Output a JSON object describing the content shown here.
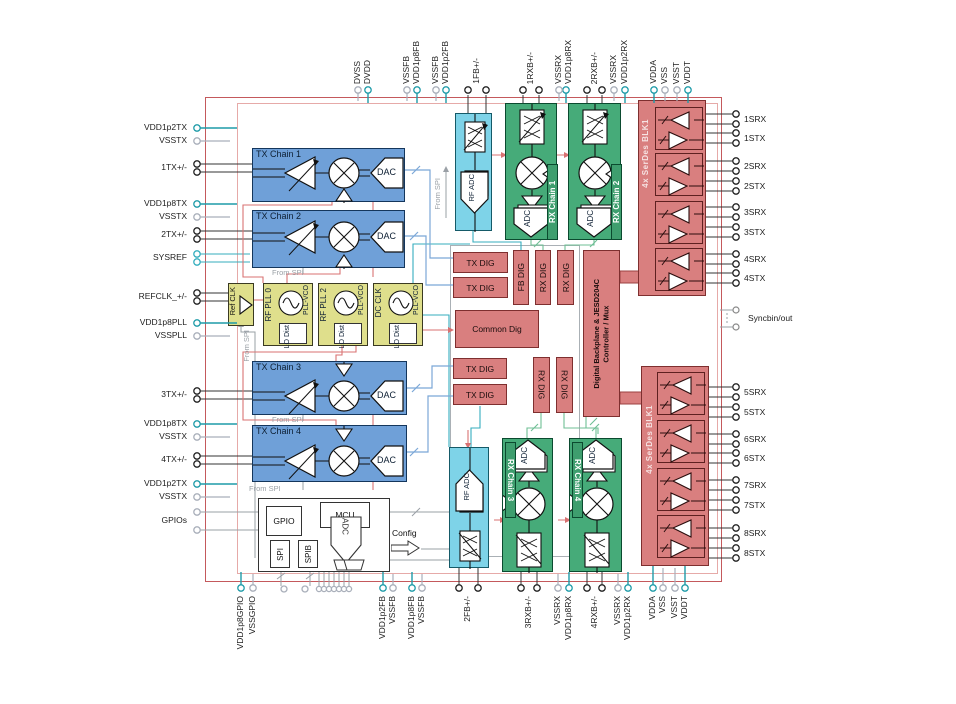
{
  "figure": {
    "kind": "functional-block-diagram"
  },
  "blocks": {
    "tx_chain_1": "TX Chain 1",
    "tx_chain_2": "TX Chain 2",
    "tx_chain_3": "TX Chain 3",
    "tx_chain_4": "TX Chain 4",
    "dac": "DAC",
    "adc": "ADC",
    "rf_adc": "RF ADC",
    "rx_chain_1": "RX Chain 1",
    "rx_chain_2": "RX Chain 2",
    "rx_chain_3": "RX Chain 3",
    "rx_chain_4": "RX Chain 4",
    "ref_clk": "Ref CLK",
    "rf_pll_0": "RF PLL 0",
    "rf_pll_2": "RF PLL 2",
    "dc_clk": "DC CLK",
    "pll_vco": "PLL-VCO",
    "lo_dist": "LO Dist",
    "tx_dig": "TX DIG",
    "fb_dig": "FB DIG",
    "rx_dig": "RX DIG",
    "common_dig": "Common Dig",
    "jesd_line1": "Digital Backplane & JESD204C",
    "jesd_line2": "Controller / Mux",
    "serdes": "4x SerDes BLK1",
    "gpio": "GPIO",
    "mcu": "MCU",
    "spi": "SPI",
    "spib": "SPIB",
    "aux_adc": "ADC",
    "config": "Config",
    "from_spi": "From SPI",
    "syncb": "Syncbin/out"
  },
  "colors": {
    "tx_blue": "#6fa0d8",
    "pll_yellow": "#dfdf8c",
    "adc_cyan": "#7ed3e8",
    "rx_green": "#46ab79",
    "digital_salmon": "#d97f7f",
    "chip_border": "#c4595c",
    "supply_teal": "#1e9ba8",
    "ground_gray": "#a9afba"
  },
  "pins": {
    "left": [
      {
        "label": "VDD1p2TX",
        "type": "supply"
      },
      {
        "label": "VSSTX",
        "type": "ground"
      },
      {
        "label": "1TX+/-",
        "type": "signal"
      },
      {
        "label": "VDD1p8TX",
        "type": "supply"
      },
      {
        "label": "VSSTX",
        "type": "ground"
      },
      {
        "label": "2TX+/-",
        "type": "signal"
      },
      {
        "label": "SYSREF",
        "type": "signal"
      },
      {
        "label": "REFCLK_+/-",
        "type": "signal"
      },
      {
        "label": "VDD1p8PLL",
        "type": "supply"
      },
      {
        "label": "VSSPLL",
        "type": "ground"
      },
      {
        "label": "3TX+/-",
        "type": "signal"
      },
      {
        "label": "VDD1p8TX",
        "type": "supply"
      },
      {
        "label": "VSSTX",
        "type": "ground"
      },
      {
        "label": "4TX+/-",
        "type": "signal"
      },
      {
        "label": "VDD1p2TX",
        "type": "supply"
      },
      {
        "label": "VSSTX",
        "type": "ground"
      },
      {
        "label": "GPIOs",
        "type": "signal"
      }
    ],
    "top": [
      {
        "label": "DVSS",
        "type": "ground"
      },
      {
        "label": "DVDD",
        "type": "supply"
      },
      {
        "label": "VSSFB",
        "type": "ground"
      },
      {
        "label": "VDD1p8FB",
        "type": "supply"
      },
      {
        "label": "VSSFB",
        "type": "ground"
      },
      {
        "label": "VDD1p2FB",
        "type": "supply"
      },
      {
        "label": "1FB+/-",
        "type": "signal"
      },
      {
        "label": "1RXB+/-",
        "type": "signal"
      },
      {
        "label": "VSSRX",
        "type": "ground"
      },
      {
        "label": "VDD1p8RX",
        "type": "supply"
      },
      {
        "label": "2RXB+/-",
        "type": "signal"
      },
      {
        "label": "VSSRX",
        "type": "ground"
      },
      {
        "label": "VDD1p2RX",
        "type": "supply"
      },
      {
        "label": "VDDA",
        "type": "supply"
      },
      {
        "label": "VSS",
        "type": "ground"
      },
      {
        "label": "VSST",
        "type": "ground"
      },
      {
        "label": "VDDT",
        "type": "supply"
      }
    ],
    "right": [
      {
        "label": "1SRX"
      },
      {
        "label": "1STX"
      },
      {
        "label": "2SRX"
      },
      {
        "label": "2STX"
      },
      {
        "label": "3SRX"
      },
      {
        "label": "3STX"
      },
      {
        "label": "4SRX"
      },
      {
        "label": "4STX"
      },
      {
        "label": "Syncbin/out"
      },
      {
        "label": "5SRX"
      },
      {
        "label": "5STX"
      },
      {
        "label": "6SRX"
      },
      {
        "label": "6STX"
      },
      {
        "label": "7SRX"
      },
      {
        "label": "7STX"
      },
      {
        "label": "8SRX"
      },
      {
        "label": "8STX"
      }
    ],
    "bottom": [
      {
        "label": "VDD1p8GPIO",
        "type": "supply"
      },
      {
        "label": "VSSGPIO",
        "type": "ground"
      },
      {
        "label": "VDD1p2FB",
        "type": "supply"
      },
      {
        "label": "VSSFB",
        "type": "ground"
      },
      {
        "label": "VDD1p8FB",
        "type": "supply"
      },
      {
        "label": "VSSFB",
        "type": "ground"
      },
      {
        "label": "2FB+/-",
        "type": "signal"
      },
      {
        "label": "3RXB+/-",
        "type": "signal"
      },
      {
        "label": "VSSRX",
        "type": "ground"
      },
      {
        "label": "VDD1p8RX",
        "type": "supply"
      },
      {
        "label": "4RXB+/-",
        "type": "signal"
      },
      {
        "label": "VSSRX",
        "type": "ground"
      },
      {
        "label": "VDD1p2RX",
        "type": "supply"
      },
      {
        "label": "VDDA",
        "type": "supply"
      },
      {
        "label": "VSS",
        "type": "ground"
      },
      {
        "label": "VSST",
        "type": "ground"
      },
      {
        "label": "VDDT",
        "type": "supply"
      }
    ]
  }
}
